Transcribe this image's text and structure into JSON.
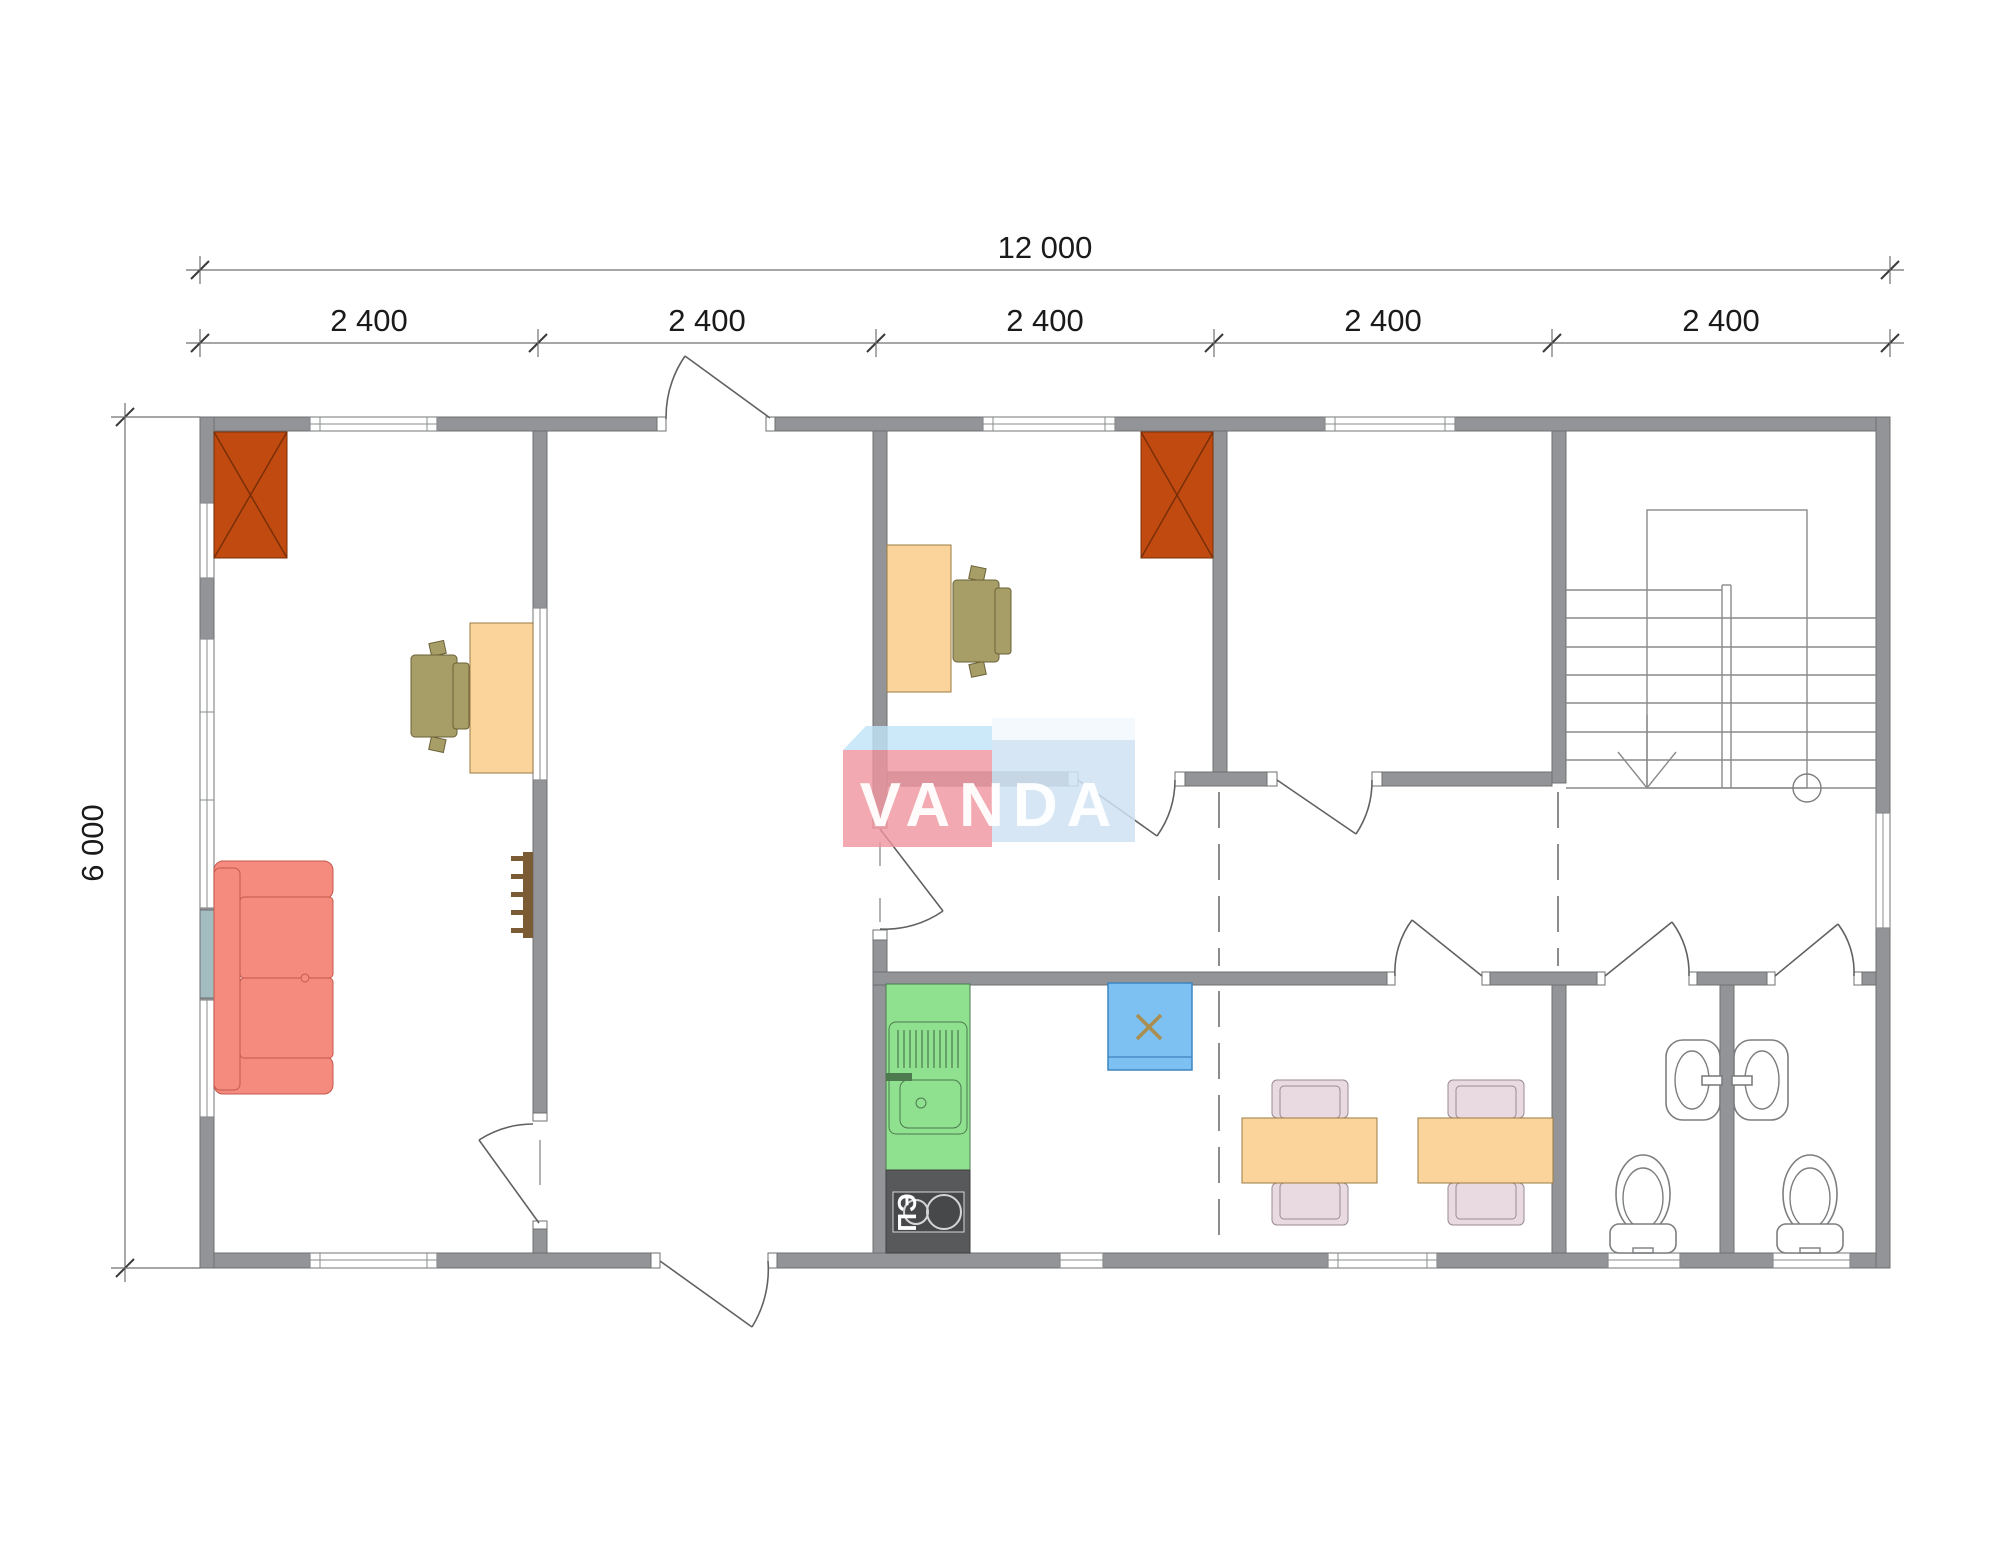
{
  "plan": {
    "dimensions": {
      "total": "12 000",
      "height": "6 000",
      "segments": [
        "2 400",
        "2 400",
        "2 400",
        "2 400",
        "2 400"
      ]
    },
    "watermark": "VANDA",
    "stove_label": "ПЭ"
  },
  "colors": {
    "wall": "#929497",
    "wallline": "#6E7072",
    "winline": "#8A8C8E",
    "doorline": "#5F6163",
    "thinline": "#7E8082",
    "stairline": "#8A8A8A",
    "fixline": "#7C7E80",
    "dimline": "#707070",
    "dimtick": "#3A3A3A",
    "dimtext": "#1A1A1A",
    "fire": "#C14A10",
    "fireline": "#7A2F08",
    "sofa": "#F58A7E",
    "sofaline": "#C4594C",
    "desk": "#FBD49B",
    "deskline": "#9A7B45",
    "ochair": "#A79D66",
    "ochairline": "#6B6239",
    "dchair": "#E9DAE1",
    "dchairline": "#9A8A92",
    "green": "#8FE08F",
    "greenline": "#4E7A50",
    "stove": "#58595B",
    "stoveinner": "#47484A",
    "stoveline": "#D6D6D6",
    "heater": "#7CC1F1",
    "heaterline": "#3E85C0",
    "xmark": "#A98E4F",
    "pier": "#A3BCC0",
    "hooks": "#7B5B33",
    "logopink": "#F0949ECC",
    "logoflap": "#BFE3F7CC",
    "logoblue": "#CFE2F2D9",
    "logotop": "#F2F8FDE6",
    "logotext": "#FFFFFFF2"
  }
}
